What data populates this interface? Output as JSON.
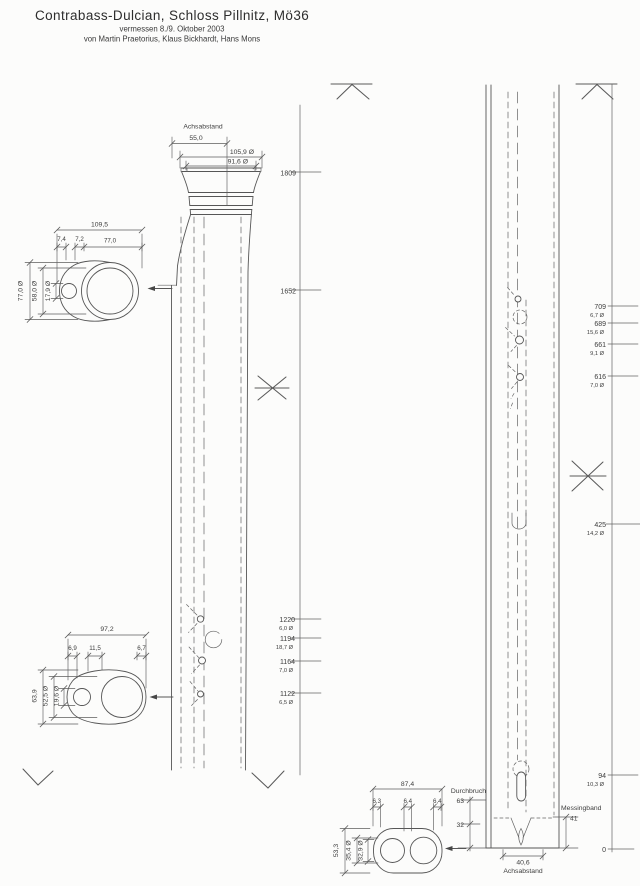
{
  "header": {
    "title": "Contrabass-Dulcian, Schloss Pillnitz, Mö36",
    "date_line": "vermessen 8./9. Oktober 2003",
    "authors_line": "von Martin Praetorius, Klaus Bickhardt, Hans Mons"
  },
  "upper_view": {
    "achsabstand_label": "Achsabstand",
    "achsabstand_value": "55,0",
    "bell_outer_diameter": "105,9 Ø",
    "bell_inner_diameter": "91,6 Ø",
    "axis_ticks": [
      {
        "position": "1809",
        "diameter": ""
      },
      {
        "position": "1652",
        "diameter": ""
      },
      {
        "position": "1220",
        "diameter": "6,0 Ø"
      },
      {
        "position": "1194",
        "diameter": "18,7 Ø"
      },
      {
        "position": "1164",
        "diameter": "7,0 Ø"
      },
      {
        "position": "1122",
        "diameter": "6,5 Ø"
      }
    ]
  },
  "section_a": {
    "total_width": "109,5",
    "segment_widths": [
      "7,4",
      "7,2",
      "77,0"
    ],
    "outer_height": "77,0 Ø",
    "bore_diameter": "58,0 Ø",
    "small_bore_diameter": "17,9 Ø"
  },
  "section_b": {
    "total_width": "97,2",
    "segment_widths": [
      "6,9",
      "11,5",
      "6,7"
    ],
    "outer_height": "63,9",
    "bore_diameter": "52,5 Ø",
    "small_bore_diameter": "19,6 Ø"
  },
  "lower_view": {
    "axis_ticks": [
      {
        "position": "709",
        "diameter": "6,7 Ø"
      },
      {
        "position": "689",
        "diameter": "15,6 Ø"
      },
      {
        "position": "661",
        "diameter": "9,1 Ø"
      },
      {
        "position": "616",
        "diameter": "7,0 Ø"
      },
      {
        "position": "425",
        "diameter": "14,2 Ø"
      },
      {
        "position": "94",
        "diameter": "10,3 Ø"
      },
      {
        "position": "0",
        "diameter": ""
      }
    ],
    "durchbruch_label": "Durchbruch",
    "durchbruch_value": "63",
    "lower_mark_value": "32",
    "messingband_label": "Messingband",
    "messingband_value": "41",
    "achsabstand_value": "40,6",
    "achsabstand_label": "Achsabstand"
  },
  "section_c": {
    "total_width": "87,4",
    "segment_widths": [
      "6,3",
      "6,4",
      "6,4"
    ],
    "outer_height": "53,3",
    "bore_diameter_1": "35,4 Ø",
    "bore_diameter_2": "32,9 Ø"
  }
}
